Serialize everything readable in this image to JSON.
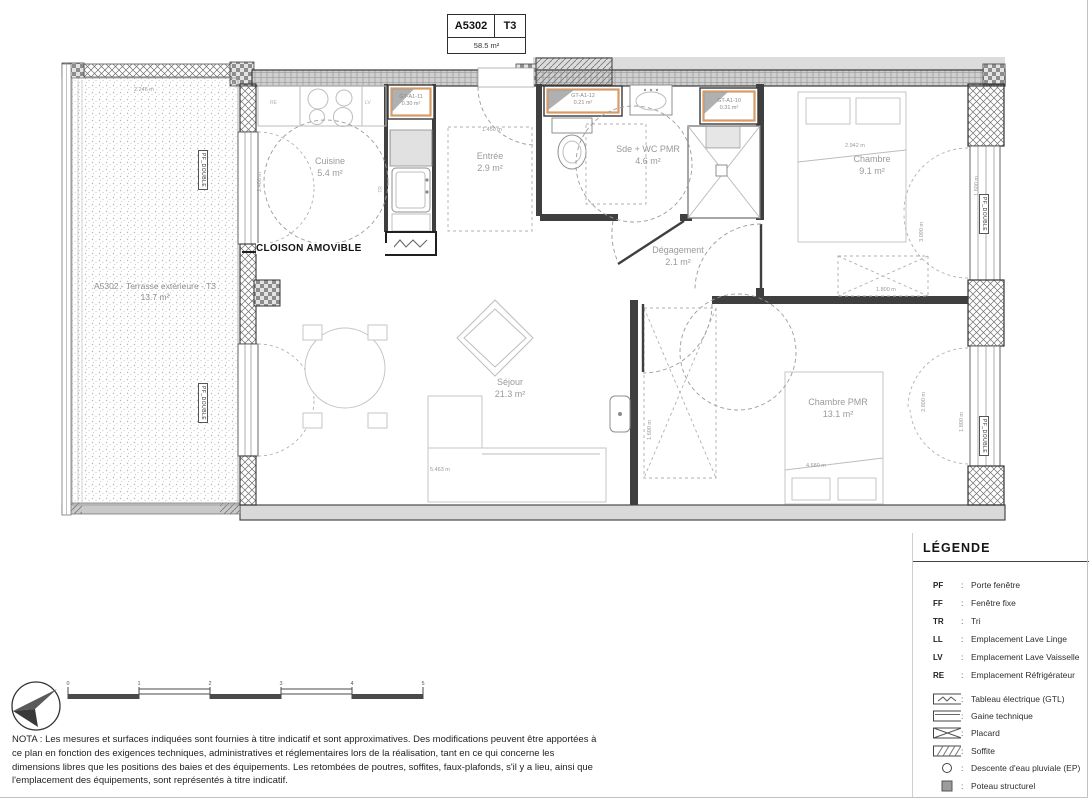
{
  "title_block": {
    "unit": "A5302",
    "type": "T3",
    "area": "58.5 m²"
  },
  "rooms": {
    "terrasse": {
      "name": "A5302 - Terrasse extérieure - T3",
      "area": "13.7 m²"
    },
    "cuisine": {
      "name": "Cuisine",
      "area": "5.4 m²"
    },
    "entree": {
      "name": "Entrée",
      "area": "2.9 m²"
    },
    "sde": {
      "name": "Sde + WC PMR",
      "area": "4.6 m²"
    },
    "chambre": {
      "name": "Chambre",
      "area": "9.1 m²"
    },
    "degagement": {
      "name": "Dégagement",
      "area": "2.1 m²"
    },
    "sejour": {
      "name": "Séjour",
      "area": "21.3 m²"
    },
    "chambre_pmr": {
      "name": "Chambre PMR",
      "area": "13.1 m²"
    }
  },
  "gt_boxes": {
    "gt11": {
      "label": "GT-A1-11",
      "area": "0.30 m²"
    },
    "gt12": {
      "label": "GT-A1-12",
      "area": "0.21 m²"
    },
    "gt10": {
      "label": "GT-A1-10",
      "area": "0.31 m²"
    }
  },
  "annotations": {
    "cloison": "CLOISON AMOVIBLE",
    "re": "RE",
    "lv": "LV",
    "tr": "TR",
    "pf_double": "PF_DOUBLE"
  },
  "dimensions": {
    "terrasse_w": "2.246 m",
    "cuisine_h": "2.400 m",
    "entree_w": "1.450 m",
    "chambre_w": "2.942 m",
    "chambre_h": "3.090 m",
    "placard_chambre": "1.800 m",
    "fenetre_chambre": "1.600 m",
    "placard_pmr": "1.600 m",
    "pmr_h": "2.800 m",
    "fenetre_pmr": "1.800 m",
    "pmr_w": "4.680 m",
    "sejour_w": "5.463 m"
  },
  "legend": {
    "title": "LÉGENDE",
    "sep": ":",
    "abbreviations": [
      {
        "key": "PF",
        "value": "Porte fenêtre"
      },
      {
        "key": "FF",
        "value": "Fenêtre fixe"
      },
      {
        "key": "TR",
        "value": "Tri"
      },
      {
        "key": "LL",
        "value": "Emplacement Lave Linge"
      },
      {
        "key": "LV",
        "value": "Emplacement Lave Vaisselle"
      },
      {
        "key": "RE",
        "value": "Emplacement Réfrigérateur"
      }
    ],
    "symbols": [
      {
        "icon": "tableau-electrique",
        "value": "Tableau électrique (GTL)"
      },
      {
        "icon": "gaine-technique",
        "value": "Gaine technique"
      },
      {
        "icon": "placard",
        "value": "Placard"
      },
      {
        "icon": "soffite",
        "value": "Soffite"
      },
      {
        "icon": "descente-eau",
        "value": "Descente d'eau pluviale (EP)"
      },
      {
        "icon": "poteau",
        "value": "Poteau structurel"
      },
      {
        "icon": "separation",
        "value": "Séparation logement"
      }
    ]
  },
  "scale_bar": {
    "ticks": [
      "0",
      "1",
      "2",
      "3",
      "4",
      "5"
    ]
  },
  "nota": "NOTA : Les mesures et surfaces indiquées sont fournies à titre indicatif et sont approximatives. Des modifications peuvent être apportées à ce plan en fonction des exigences techniques, administratives et réglementaires lors de la réalisation, tant en ce qui concerne les dimensions libres que les positions des baies et des équipements. Les retombées de poutres, soffites, faux-plafonds, s'il y a lieu, ainsi que l'emplacement des équipements, sont représentés à titre indicatif.",
  "colors": {
    "accent_orange": "#D99B66",
    "wall_dark": "#3F3F3F",
    "band_gray": "#D9D9D9"
  }
}
